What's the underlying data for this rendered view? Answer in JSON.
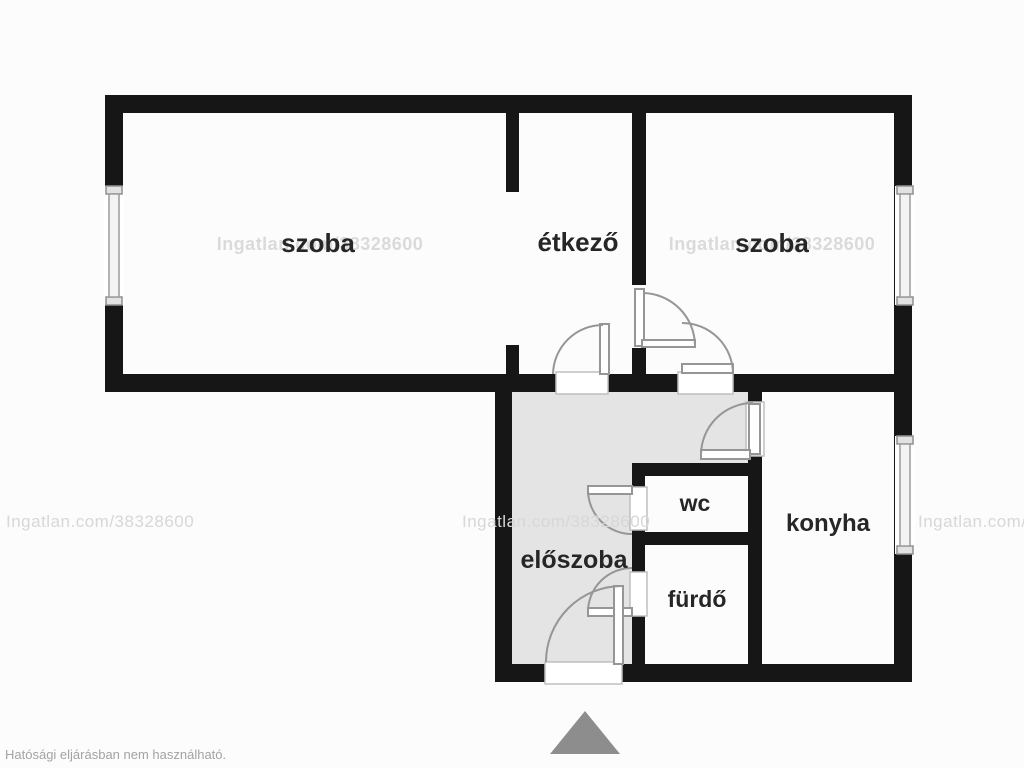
{
  "page": {
    "watermark": "Ingatlan.com/38328600",
    "disclaimer": "Hatósági eljárásban nem használható."
  },
  "colors": {
    "bg": "#fcfcfd",
    "wall": "#161616",
    "hallFloor": "#e4e4e4",
    "door": "#969696",
    "watermark": "#d7d7d7",
    "label": "#262626",
    "mutedText": "#a3a3a3",
    "north": "#8d8d8d"
  },
  "rooms": [
    {
      "id": "szoba-left",
      "label": "szoba"
    },
    {
      "id": "etkezo",
      "label": "étkező"
    },
    {
      "id": "szoba-right",
      "label": "szoba"
    },
    {
      "id": "eloszoba",
      "label": "előszoba"
    },
    {
      "id": "wc",
      "label": "wc"
    },
    {
      "id": "furdo",
      "label": "fürdő"
    },
    {
      "id": "konyha",
      "label": "konyha"
    }
  ]
}
